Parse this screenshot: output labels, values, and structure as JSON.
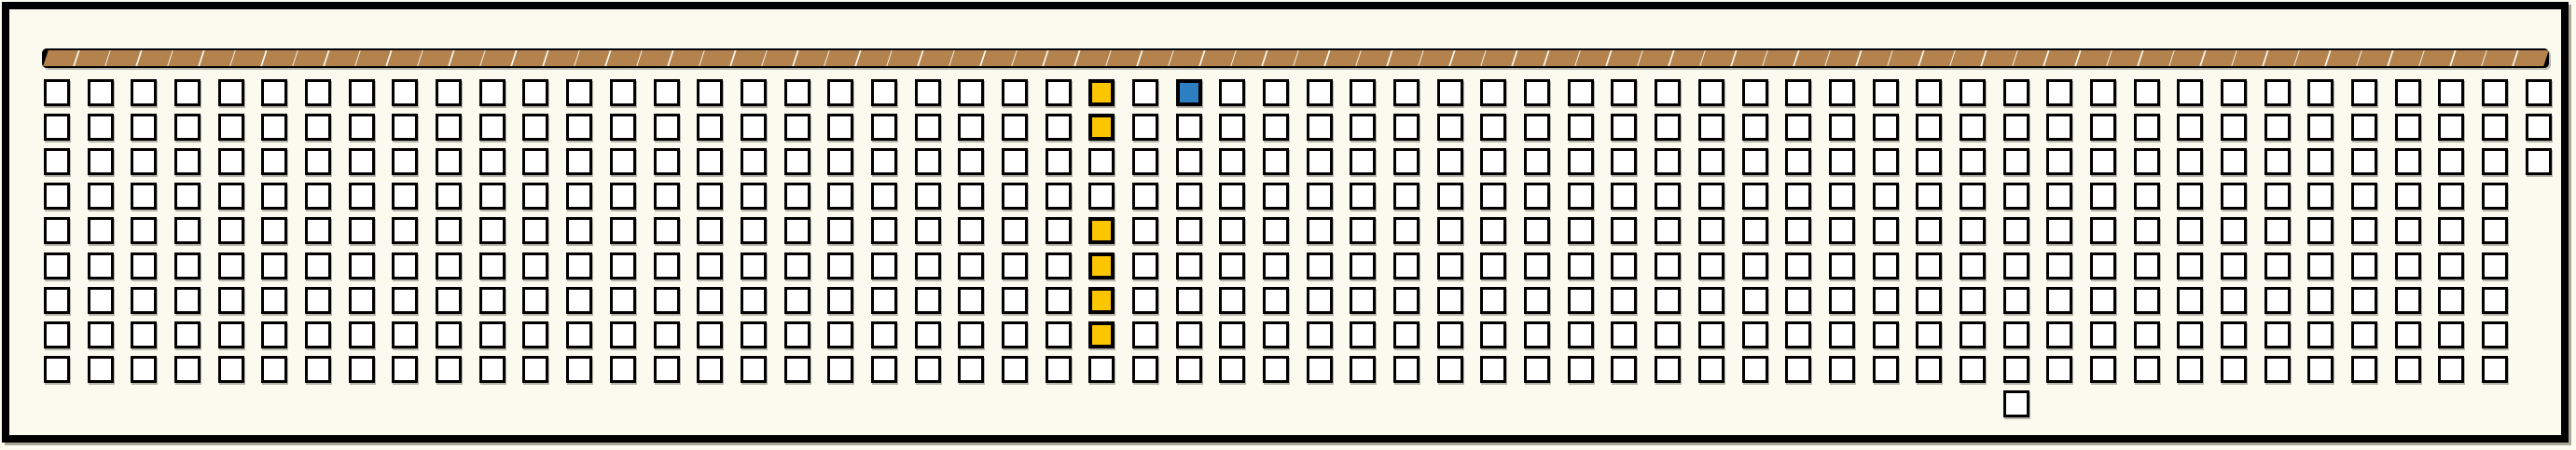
{
  "colors": {
    "background": "#fbfaef",
    "frame": "#000000",
    "frame_shadow": "#a9a79b",
    "seat_fill": "#ffffff",
    "seat_border": "#000000",
    "selected_yellow": "#fcc500",
    "selected_blue": "#2e7fc1",
    "ribbon_brown": "#b3824d"
  },
  "ribbon": {
    "tile_count": 80
  },
  "grid": {
    "columns": 58,
    "row_count": 10,
    "cell_legend": {
      "O": "available",
      "Y": "selected-yellow",
      "B": "selected-blue",
      ".": "absent"
    },
    "rows": [
      "OOOOOOOOOOOOOOOOOOOOOOOOYOBOOOOOOOOOOOOOOOOOOOOOOOOOOOOOOO",
      "OOOOOOOOOOOOOOOOOOOOOOOOYOOOOOOOOOOOOOOOOOOOOOOOOOOOOOOOOO",
      "OOOOOOOOOOOOOOOOOOOOOOOOOOOOOOOOOOOOOOOOOOOOOOOOOOOOOOOOOO",
      "OOOOOOOOOOOOOOOOOOOOOOOOOOOOOOOOOOOOOOOOOOOOOOOOOOOOOOOOO.",
      "OOOOOOOOOOOOOOOOOOOOOOOOYOOOOOOOOOOOOOOOOOOOOOOOOOOOOOOOO.",
      "OOOOOOOOOOOOOOOOOOOOOOOOYOOOOOOOOOOOOOOOOOOOOOOOOOOOOOOOO.",
      "OOOOOOOOOOOOOOOOOOOOOOOOYOOOOOOOOOOOOOOOOOOOOOOOOOOOOOOOO.",
      "OOOOOOOOOOOOOOOOOOOOOOOOYOOOOOOOOOOOOOOOOOOOOOOOOOOOOOOOO.",
      "OOOOOOOOOOOOOOOOOOOOOOOOOOOOOOOOOOOOOOOOOOOOOOOOOOOOOOOOO.",
      ".............................................O............"
    ],
    "selected_yellow_count": 6,
    "selected_blue_count": 1
  }
}
